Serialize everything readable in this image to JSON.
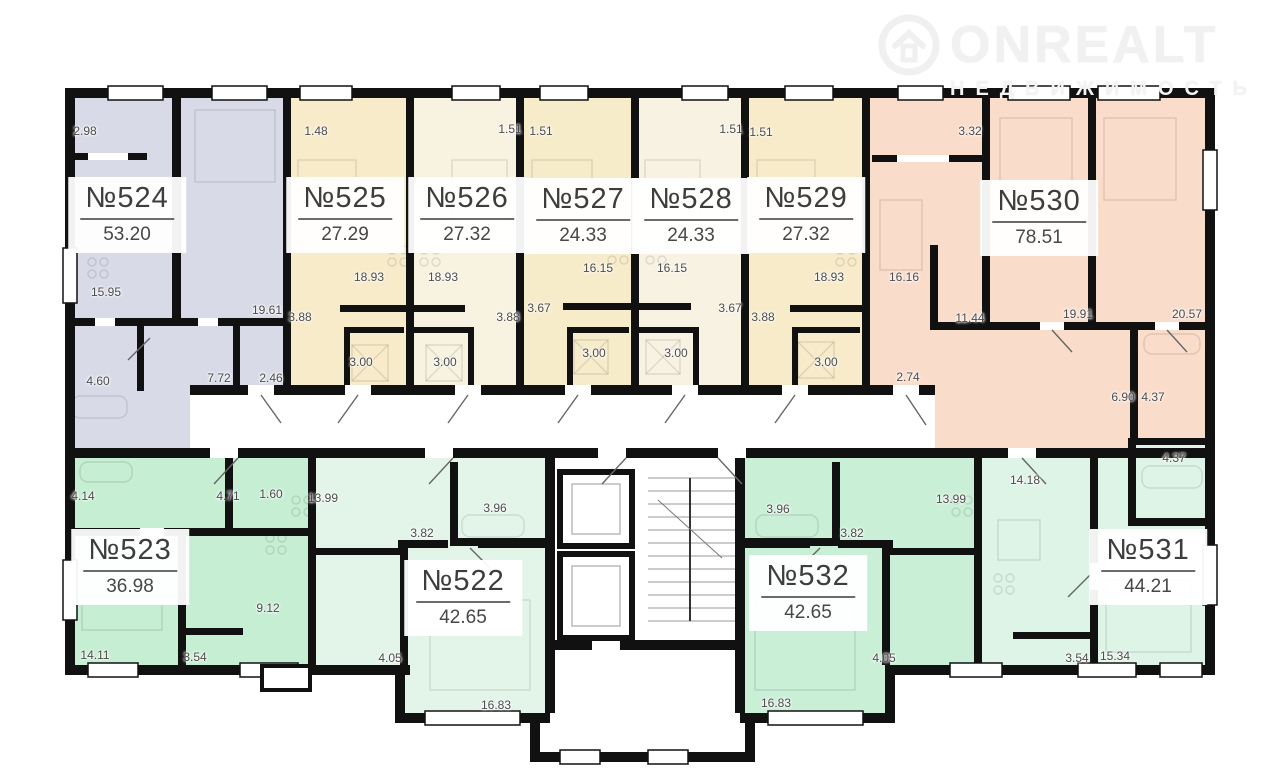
{
  "watermark": {
    "brand": "ONREALT",
    "subtitle": "НЕДВИЖИМОСТЬ",
    "icon": "house-in-circle",
    "color": "#f1f1f1"
  },
  "palette": {
    "wall": "#111111",
    "background": "#ffffff",
    "label_text": "#4c4c4c"
  },
  "floor_plan": {
    "apartments": [
      {
        "id": "524",
        "number": "№524",
        "area": "53.20",
        "color": "#d8dae8",
        "rooms": [
          "2.98",
          "15.95",
          "19.61",
          "4.60",
          "7.72",
          "2.46"
        ]
      },
      {
        "id": "525",
        "number": "№525",
        "area": "27.29",
        "color": "#f7ebc9",
        "rooms": [
          "1.48",
          "18.93",
          "3.88",
          "3.00"
        ]
      },
      {
        "id": "526",
        "number": "№526",
        "area": "27.32",
        "color": "#f8f2e0",
        "rooms": [
          "1.51",
          "18.93",
          "3.88",
          "3.00"
        ]
      },
      {
        "id": "527",
        "number": "№527",
        "area": "24.33",
        "color": "#f7ecca",
        "rooms": [
          "1.51",
          "16.15",
          "3.67",
          "3.00"
        ]
      },
      {
        "id": "528",
        "number": "№528",
        "area": "24.33",
        "color": "#f8f2e2",
        "rooms": [
          "1.51",
          "16.15",
          "3.67",
          "3.00"
        ]
      },
      {
        "id": "529",
        "number": "№529",
        "area": "27.32",
        "color": "#f7ebc9",
        "rooms": [
          "1.51",
          "18.93",
          "3.88",
          "3.00"
        ]
      },
      {
        "id": "530",
        "number": "№530",
        "area": "78.51",
        "color": "#fadcca",
        "rooms": [
          "3.32",
          "16.16",
          "11.44",
          "19.91",
          "20.57",
          "2.74",
          "6.90",
          "4.37"
        ]
      },
      {
        "id": "523",
        "number": "№523",
        "area": "36.98",
        "color": "#c5eed2",
        "rooms": [
          "4.14",
          "4.71",
          "1.60",
          "9.12",
          "14.11",
          "3.54"
        ]
      },
      {
        "id": "522",
        "number": "№522",
        "area": "42.65",
        "color": "#e3f5e9",
        "rooms": [
          "13.99",
          "3.96",
          "3.82",
          "4.05",
          "16.83"
        ]
      },
      {
        "id": "532",
        "number": "№532",
        "area": "42.65",
        "color": "#c9efd6",
        "rooms": [
          "3.96",
          "3.82",
          "13.99",
          "4.05",
          "16.83"
        ]
      },
      {
        "id": "531",
        "number": "№531",
        "area": "44.21",
        "color": "#def4e6",
        "rooms": [
          "4.37",
          "14.18",
          "3.54",
          "15.34"
        ]
      }
    ],
    "core": {
      "features": [
        "elevator-shaft",
        "elevator-shaft",
        "staircase",
        "vestibule"
      ]
    }
  }
}
